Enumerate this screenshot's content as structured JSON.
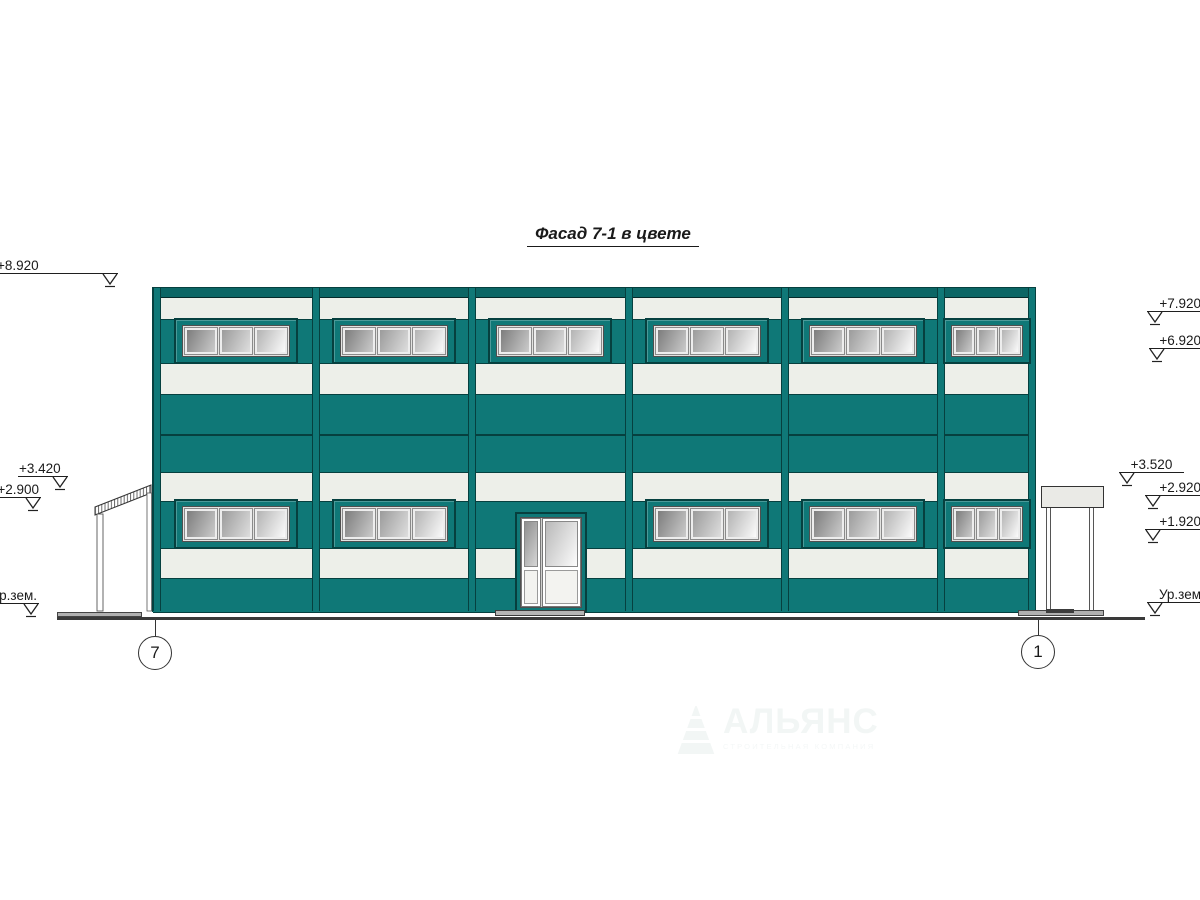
{
  "drawing": {
    "title": "Фасад 7-1 в цвете",
    "watermark": {
      "brand": "АЛЬЯНС",
      "tagline": "СТРОИТЕЛЬНАЯ КОМПАНИЯ"
    },
    "elevation_marks_left": [
      {
        "label": "+8.920"
      },
      {
        "label": "+3.420"
      },
      {
        "label": "+2.900"
      },
      {
        "label": "Ур.зем."
      }
    ],
    "elevation_marks_right": [
      {
        "label": "+7.920"
      },
      {
        "label": "+6.920"
      },
      {
        "label": "+3.520"
      },
      {
        "label": "+2.920"
      },
      {
        "label": "+1.920"
      },
      {
        "label": "Ур.зем"
      }
    ],
    "axis_markers": [
      {
        "label": "7"
      },
      {
        "label": "1"
      }
    ],
    "colors": {
      "facade_teal": "#0F7877",
      "facade_teal_dark": "#0B6665",
      "panel_white": "#EDEFE9",
      "outline_dark": "#06403F",
      "ground": "#3A3A3A"
    }
  }
}
